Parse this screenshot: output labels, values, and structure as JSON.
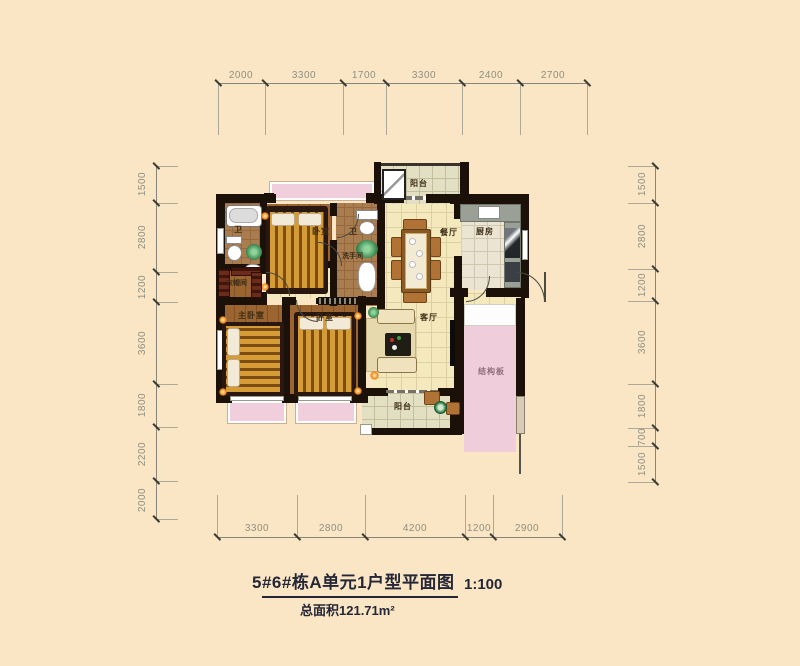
{
  "title": {
    "main": "5#6#栋A单元1户型平面图",
    "scale": "1:100",
    "area": "总面积121.71m²"
  },
  "dimensions": {
    "top": [
      "2000",
      "3300",
      "1700",
      "3300",
      "2400",
      "2700"
    ],
    "left": [
      "1500",
      "2800",
      "1200",
      "3600",
      "1800",
      "2200",
      "2000"
    ],
    "right": [
      "1500",
      "2800",
      "1200",
      "3600",
      "1800",
      "700",
      "1500"
    ],
    "bottom": [
      "3300",
      "2800",
      "4200",
      "1200",
      "2900"
    ]
  },
  "rooms": {
    "bath1": "卫",
    "bedroom_top": "卧室",
    "bath2": "卫",
    "washroom": "洗手间",
    "balcony_top": "阳台",
    "dining": "餐厅",
    "kitchen": "厨房",
    "cloakroom": "衣帽间",
    "master_bedroom": "主卧室",
    "bedroom_side": "卧室",
    "living": "客厅",
    "slab": "结构板",
    "balcony_bottom": "阳台"
  },
  "colors": {
    "background": "#FAE6C5",
    "wall": "#1B1109",
    "bay_window_pink": "#F0CEDC",
    "structural_slab_pink": "#EFCDDA",
    "tile_floor": "#F3E9BC",
    "wood_floor": "#9A6531",
    "bed_gold": "#D59B35",
    "dimension_text": "#8F8F80",
    "title_text": "#252737"
  }
}
